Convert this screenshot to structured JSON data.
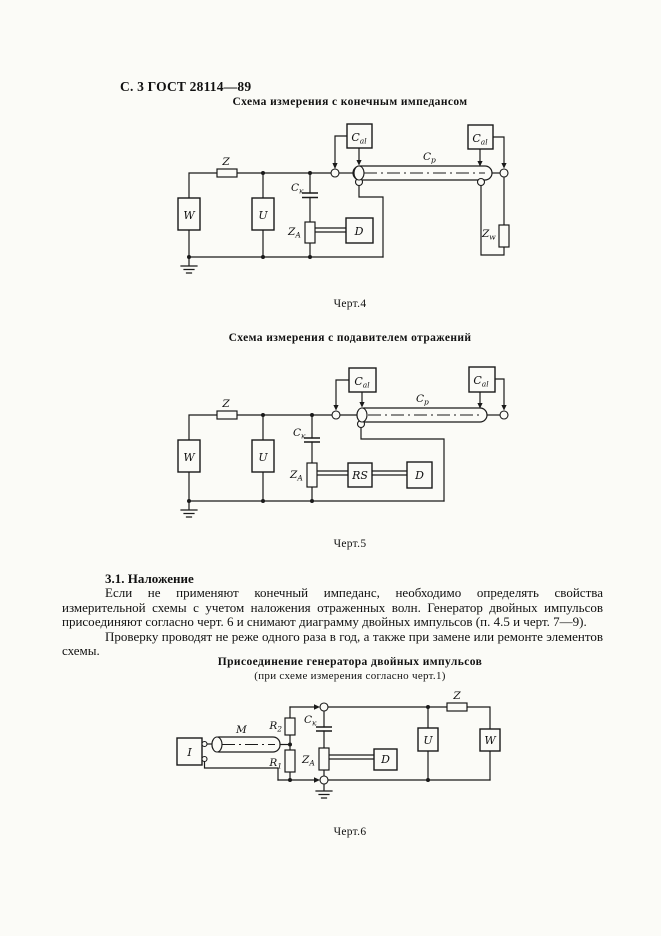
{
  "page": {
    "header": "С. 3 ГОСТ 28114—89"
  },
  "fig4": {
    "title": "Схема измерения с конечным импедансом",
    "caption": "Черт.4",
    "labels": {
      "z": "Z",
      "w": "W",
      "u": "U",
      "d": "D",
      "ck": {
        "main": "C",
        "sub": "к"
      },
      "za": {
        "main": "Z",
        "sub": "А"
      },
      "cal_left": {
        "main": "C",
        "sub": "al"
      },
      "cal_right": {
        "main": "C",
        "sub": "al"
      },
      "cp": {
        "main": "C",
        "sub": "p"
      },
      "zw": {
        "main": "Z",
        "sub": "w"
      }
    }
  },
  "fig5": {
    "title": "Схема измерения с подавителем отражений",
    "caption": "Черт.5",
    "labels": {
      "z": "Z",
      "w": "W",
      "u": "U",
      "d": "D",
      "rs": "RS",
      "ck": {
        "main": "C",
        "sub": "к"
      },
      "za": {
        "main": "Z",
        "sub": "А"
      },
      "cal_left": {
        "main": "C",
        "sub": "al"
      },
      "cal_right": {
        "main": "C",
        "sub": "al"
      },
      "cp": {
        "main": "C",
        "sub": "p"
      }
    }
  },
  "section": {
    "heading": "3.1. Наложение",
    "para1": "Если не применяют конечный импеданс, необходимо определять свойства измерительной схемы с учетом наложения отраженных волн. Генератор двойных импульсов присоединяют согласно черт. 6 и снимают диаграмму двойных импульсов (п. 4.5 и черт. 7—9).",
    "para2": "Проверку проводят не реже одного раза в год, а также при замене или ремонте элементов схемы."
  },
  "fig6": {
    "title": "Присоединение генератора двойных импульсов",
    "subtitle": "(при схеме измерения согласно черт.1)",
    "caption": "Черт.6",
    "labels": {
      "i": "I",
      "m": "M",
      "z": "Z",
      "w": "W",
      "u": "U",
      "d": "D",
      "r1": {
        "main": "R",
        "sub": "1"
      },
      "r2": {
        "main": "R",
        "sub": "2"
      },
      "ck": {
        "main": "C",
        "sub": "к"
      },
      "za": {
        "main": "Z",
        "sub": "А"
      }
    }
  }
}
